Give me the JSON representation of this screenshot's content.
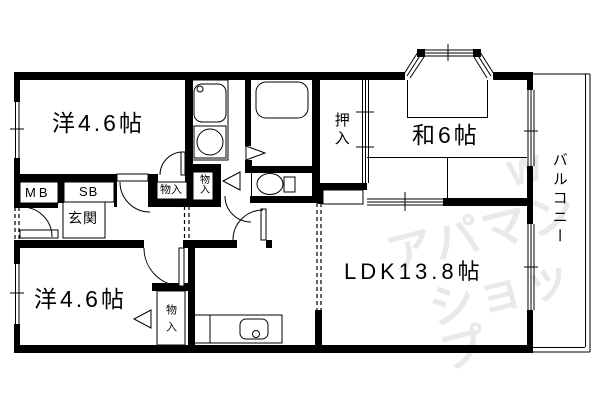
{
  "title": "apartment-floorplan",
  "rooms": {
    "western1": {
      "label": "洋4.6帖"
    },
    "western2": {
      "label": "洋4.6帖"
    },
    "japanese": {
      "label": "和6帖"
    },
    "ldk": {
      "label": "LDK13.8帖"
    },
    "balcony": {
      "label": "バルコニー"
    },
    "genkan": {
      "label": "玄関"
    },
    "oshiire": {
      "label": "押入"
    },
    "closet_hall": {
      "label": "物入"
    },
    "closet_wash": {
      "label": "物入"
    },
    "closet_south": {
      "label": "物入"
    },
    "meter_box": {
      "label": "MB"
    },
    "shoe_box": {
      "label": "SB"
    }
  },
  "watermark": {
    "line1": "アパマン",
    "line2": "ショップ",
    "mark": "W"
  },
  "colors": {
    "wall": "#000000",
    "background": "#ffffff",
    "watermark": "#e9e9e9"
  }
}
